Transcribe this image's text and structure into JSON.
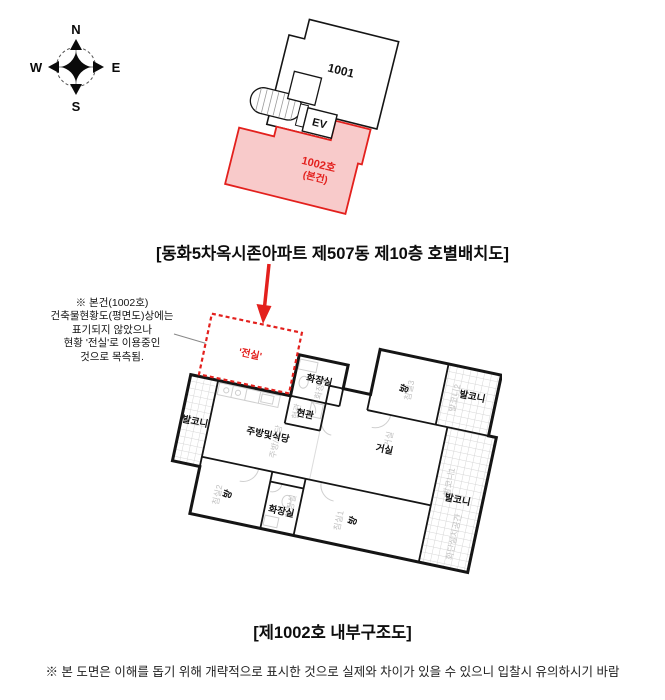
{
  "compass": {
    "north": "N",
    "east": "E",
    "south": "S",
    "west": "W"
  },
  "unit_layout_diagram": {
    "unit_1001_label": "1001",
    "elevator_label": "EV",
    "unit_1002_label": "1002호",
    "unit_1002_sublabel": "(본건)"
  },
  "captions": {
    "unit_layout_caption": "[동화5차옥시존아파트 제507동 제10층 호별배치도]",
    "floor_plan_caption": "[제1002호 내부구조도]",
    "disclaimer": "※ 본 도면은 이해를 돕기 위해 개략적으로 표시한 것으로 실제와 차이가 있을 수 있으니 입찰시 유의하시기 바람"
  },
  "annotation": {
    "line1": "※ 본건(1002호)",
    "line2": "건축물현황도(평면도)상에는",
    "line3": "표기되지 않았으나",
    "line4": "현황 '전실'로 이용중인",
    "line5": "것으로 목측됨."
  },
  "floor_plan": {
    "front_room_label": "'전실'",
    "bathroom_top_label": "화장실",
    "entrance_label": "현관",
    "room_top_right_label": "방",
    "balcony_top_right_label": "발코니",
    "living_room_label": "거실",
    "kitchen_label": "주방및식당",
    "balcony_left_label": "발코니",
    "room_bottom_left_label": "방",
    "bathroom_bottom_label": "화장실",
    "room_bottom_right_label": "방",
    "balcony_right_label": "발코니",
    "underlay": {
      "bedroom3": "침실3",
      "balcony2": "발코니2",
      "bedroom2": "침실2",
      "bedroom1": "침실1",
      "balcony1": "발코니1",
      "flower_bed": "화단설치공간",
      "kitchen_dining": "주방/식당",
      "living": "거실",
      "bath_top": "화장실",
      "bath_bottom": "화장실",
      "entrance": "현관"
    }
  },
  "colors": {
    "highlight_fill": "#f8caca",
    "highlight_stroke": "#e3201d",
    "accent_red": "#e3201d",
    "wall_black": "#151515",
    "underlay_gray": "#c2c2c2"
  }
}
